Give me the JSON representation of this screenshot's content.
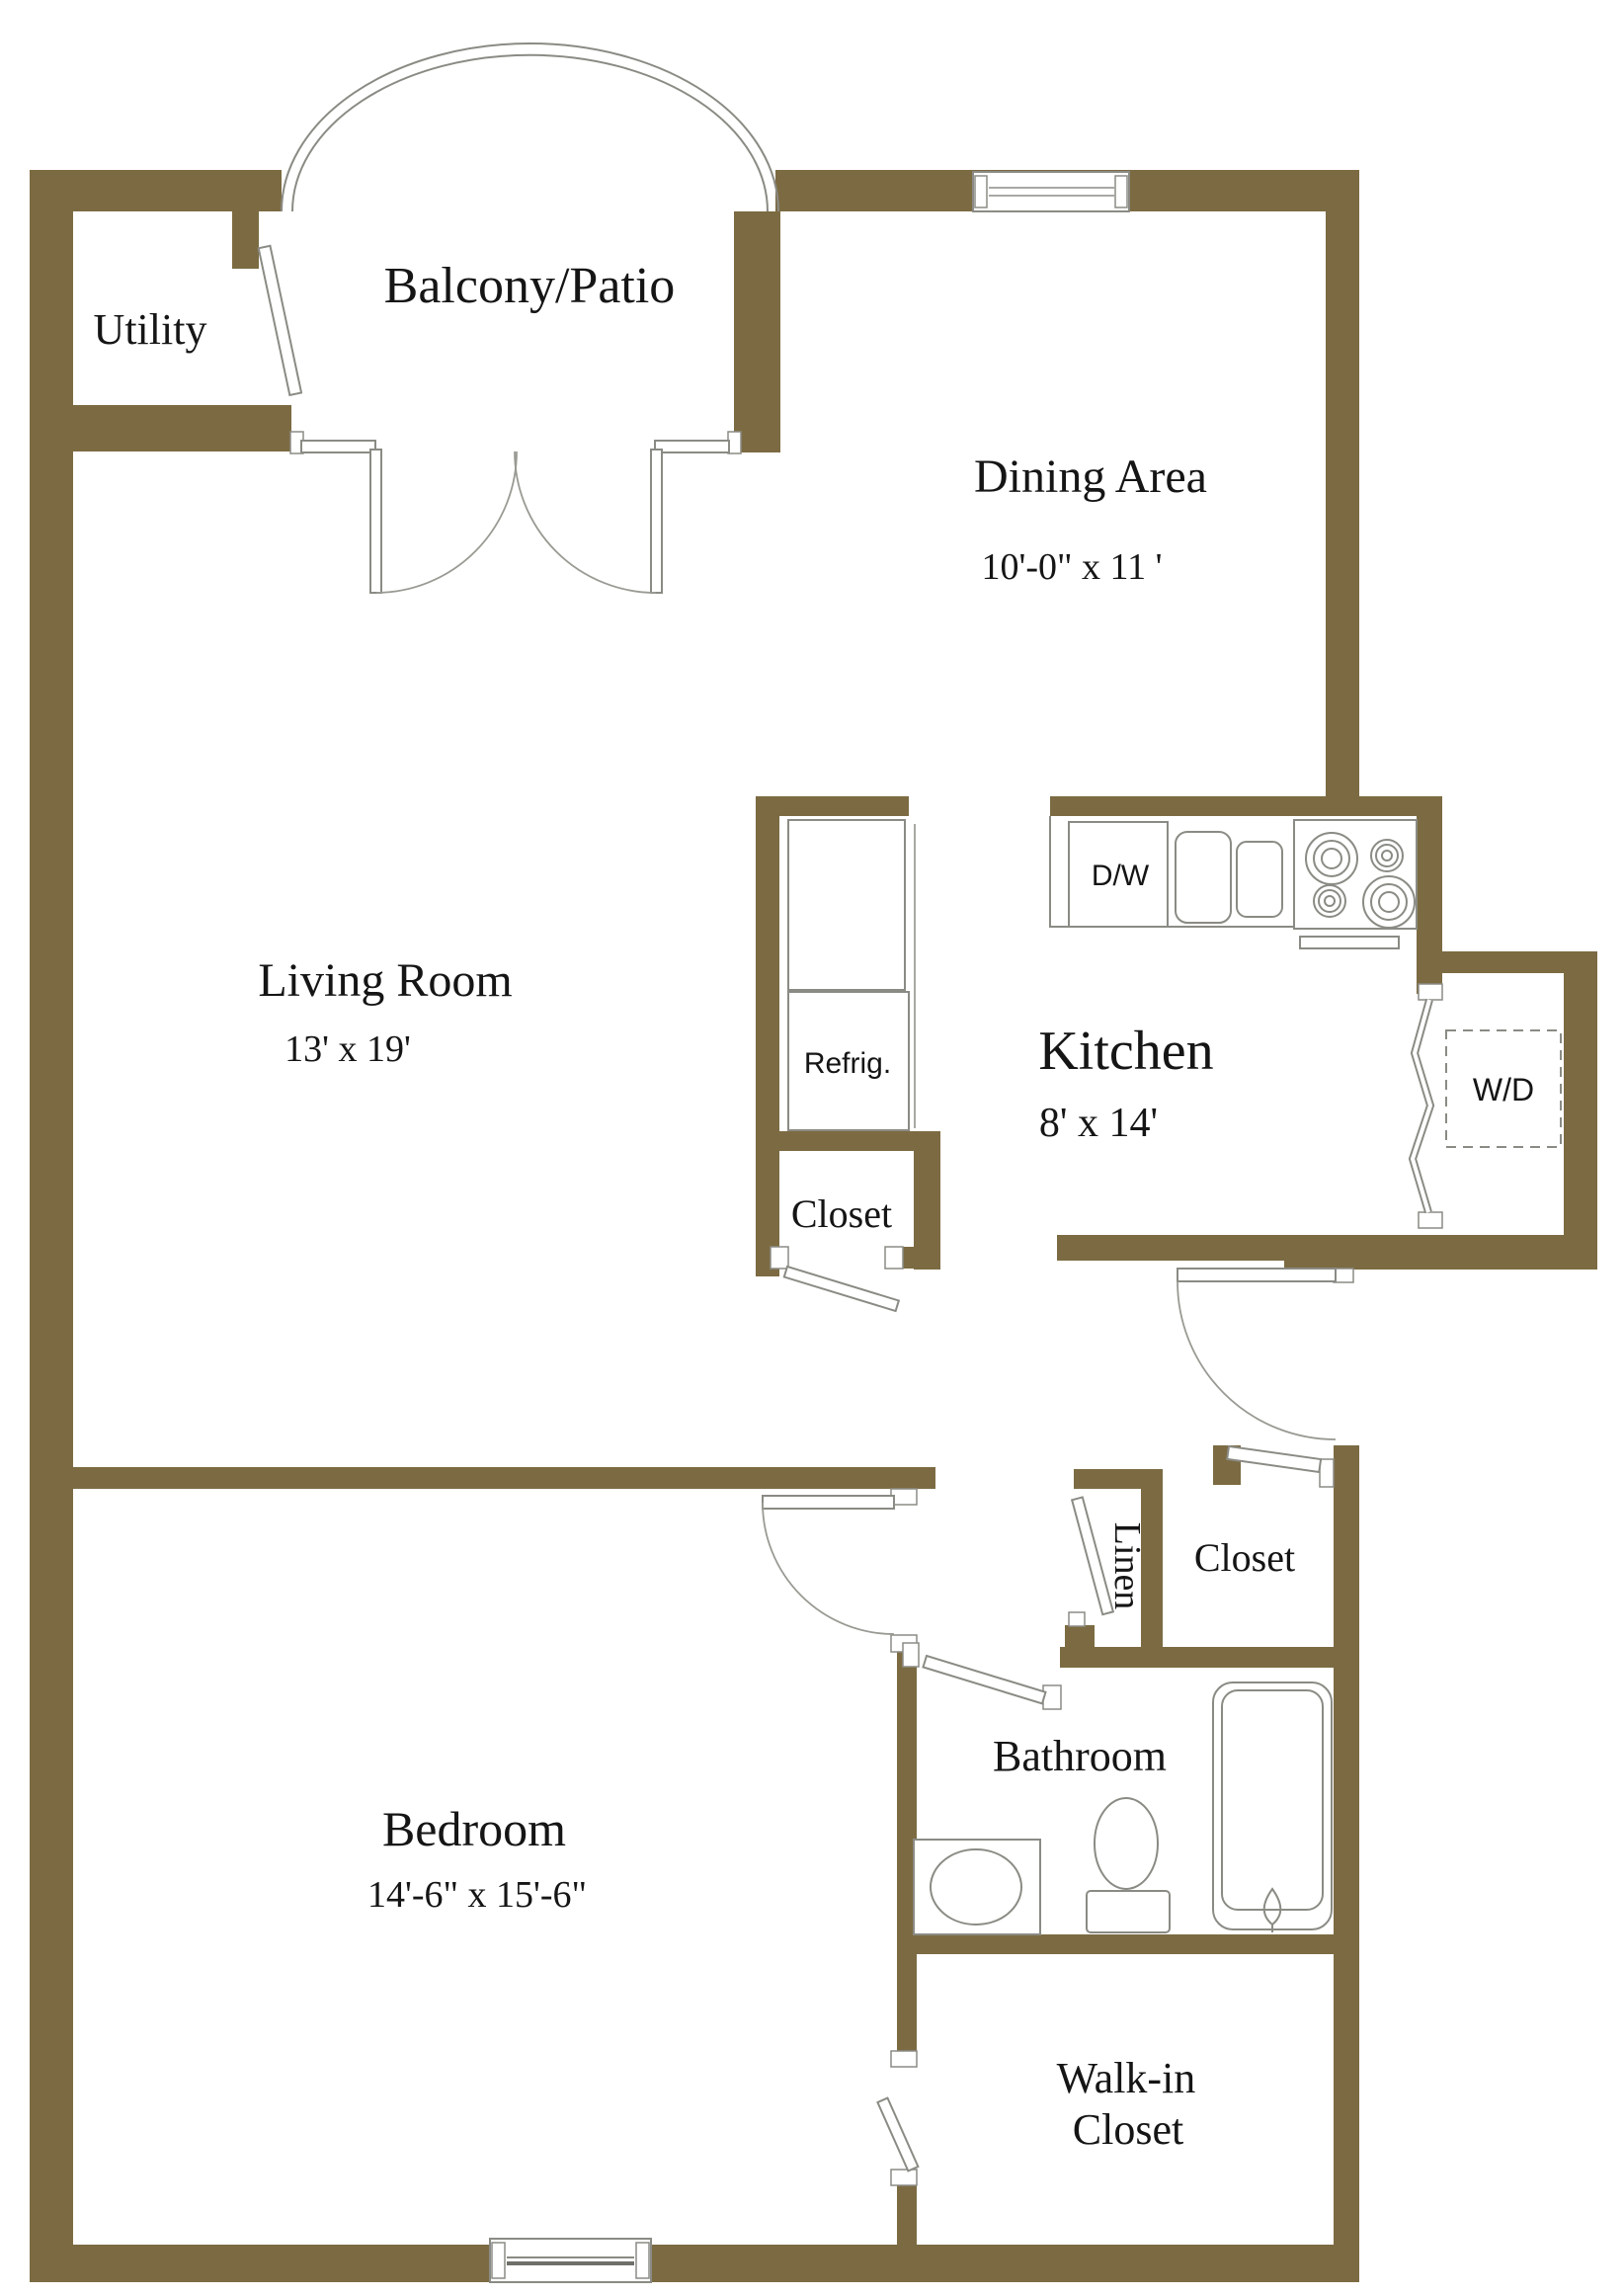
{
  "floorplan": {
    "background_color": "#FFFFFF",
    "wall_color": "#7C6B42",
    "line_color": "#8B8B85",
    "text_color": "#151515",
    "rooms": {
      "utility": {
        "name": "Utility"
      },
      "balcony_patio": {
        "name": "Balcony/Patio"
      },
      "dining_area": {
        "name": "Dining Area",
        "dimensions": "10'-0\" x 11 '"
      },
      "living_room": {
        "name": "Living Room",
        "dimensions": "13' x 19'"
      },
      "kitchen": {
        "name": "Kitchen",
        "dimensions": "8' x 14'"
      },
      "bedroom": {
        "name": "Bedroom",
        "dimensions": "14'-6\" x 15'-6\""
      },
      "bathroom": {
        "name": "Bathroom"
      },
      "walk_in_closet": {
        "line1": "Walk-in",
        "line2": "Closet"
      },
      "pantry_closet": {
        "name": "Closet"
      },
      "hall_closet": {
        "name": "Closet"
      },
      "linen_closet": {
        "name": "Linen"
      }
    },
    "appliances": {
      "dishwasher": "D/W",
      "refrigerator": "Refrig.",
      "washer_dryer": "W/D"
    }
  }
}
